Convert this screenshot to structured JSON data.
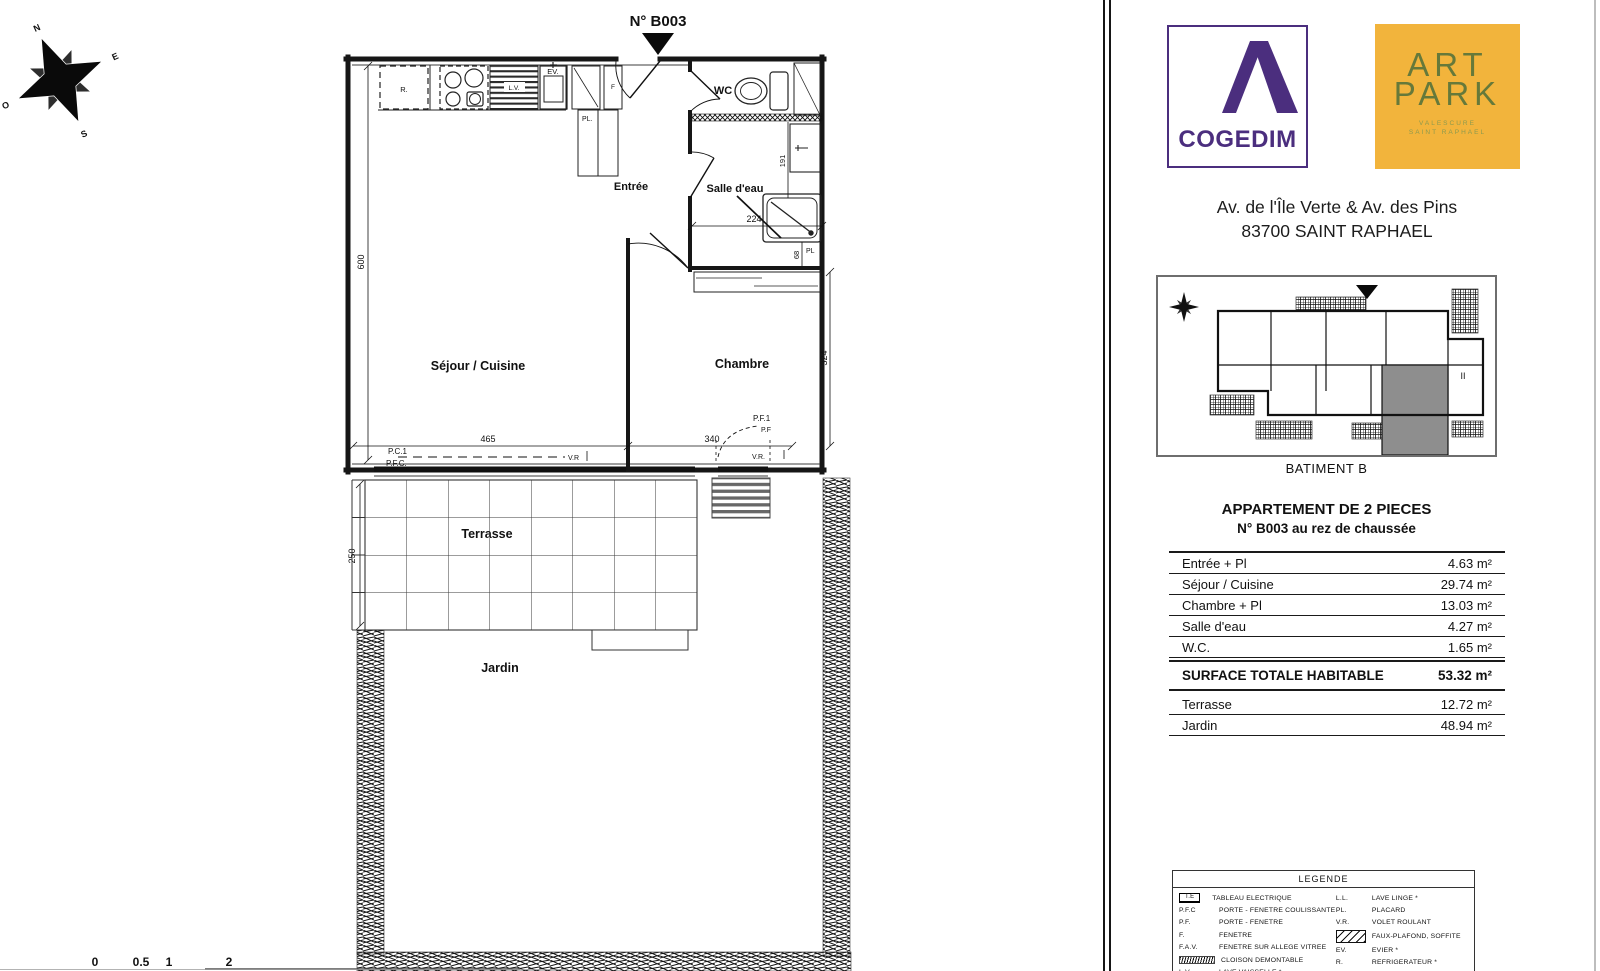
{
  "plan": {
    "marker": "N° B003",
    "compass": {
      "n": "N",
      "e": "E",
      "s": "S",
      "o": "O"
    },
    "rooms": {
      "sejour": "Séjour / Cuisine",
      "chambre": "Chambre",
      "entree": "Entrée",
      "salle_eau": "Salle d'eau",
      "wc": "WC",
      "terrasse": "Terrasse",
      "jardin": "Jardin"
    },
    "fixtures": {
      "refrigerateur": "R.",
      "evier": "EV.",
      "lave_vaisselle": "L.V.",
      "fenetre": "F",
      "placard_entree": "PL.",
      "placard_chambre": "PL"
    },
    "dims": {
      "sejour_h": "600",
      "sejour_w": "465",
      "chambre_w": "340",
      "chambre_h": "324",
      "sde_w": "224",
      "sde_h": "191",
      "placard": "68",
      "terrasse_h": "250"
    },
    "openings": {
      "pc1": "P.C.1",
      "pfc": "P.F.C.",
      "vr_sejour": "V.R",
      "pf1": "P.F.1",
      "pf": "P.F",
      "vr_chambre": "V.R."
    },
    "scale": {
      "t0": "0",
      "t1": "0.5",
      "t2": "1",
      "t3": "2"
    }
  },
  "sidebar": {
    "cogedim": {
      "name": "COGEDIM"
    },
    "artpark": {
      "line1": "ART",
      "line2": "PARK",
      "sub1": "VALESCURE",
      "sub2": "SAINT RAPHAEL"
    },
    "address1": "Av. de l'Île Verte & Av. des Pins",
    "address2": "83700 SAINT RAPHAEL",
    "keyplan": {
      "caption": "BATIMENT B",
      "level": "II"
    },
    "title1": "APPARTEMENT DE 2 PIECES",
    "title2": "N° B003 au rez de chaussée",
    "table": {
      "rows": [
        {
          "label": "Entrée + Pl",
          "value": "4.63 m²"
        },
        {
          "label": "Séjour / Cuisine",
          "value": "29.74 m²"
        },
        {
          "label": "Chambre + Pl",
          "value": "13.03 m²"
        },
        {
          "label": "Salle d'eau",
          "value": "4.27 m²"
        },
        {
          "label": "W.C.",
          "value": "1.65 m²"
        }
      ],
      "total": {
        "label": "SURFACE TOTALE HABITABLE",
        "value": "53.32 m²"
      },
      "outdoor": [
        {
          "label": "Terrasse",
          "value": "12.72 m²"
        },
        {
          "label": "Jardin",
          "value": "48.94 m²"
        }
      ]
    },
    "legend": {
      "title": "LEGENDE",
      "left": [
        {
          "abbr": "T.E",
          "label": "TABLEAU ELECTRIQUE"
        },
        {
          "abbr": "P.F.C",
          "label": "PORTE - FENETRE COULISSANTE"
        },
        {
          "abbr": "P.F.",
          "label": "PORTE - FENETRE"
        },
        {
          "abbr": "F.",
          "label": "FENETRE"
        },
        {
          "abbr": "F.A.V.",
          "label": "FENETRE SUR ALLEGE VITREE"
        },
        {
          "abbr": "",
          "label": "CLOISON DEMONTABLE"
        },
        {
          "abbr": "L.V.",
          "label": "LAVE VAISSELLE *"
        }
      ],
      "right": [
        {
          "abbr": "L.L.",
          "label": "LAVE LINGE *"
        },
        {
          "abbr": "PL.",
          "label": "PLACARD"
        },
        {
          "abbr": "V.R.",
          "label": "VOLET ROULANT"
        },
        {
          "abbr": "",
          "label": "FAUX-PLAFOND, SOFFITE"
        },
        {
          "abbr": "EV.",
          "label": "EVIER *"
        },
        {
          "abbr": "R.",
          "label": "REFRIGERATEUR *"
        }
      ]
    }
  },
  "colors": {
    "cogedim_purple": "#4B2E7E",
    "artpark_yellow": "#F2B43C",
    "artpark_green": "#66793A"
  }
}
